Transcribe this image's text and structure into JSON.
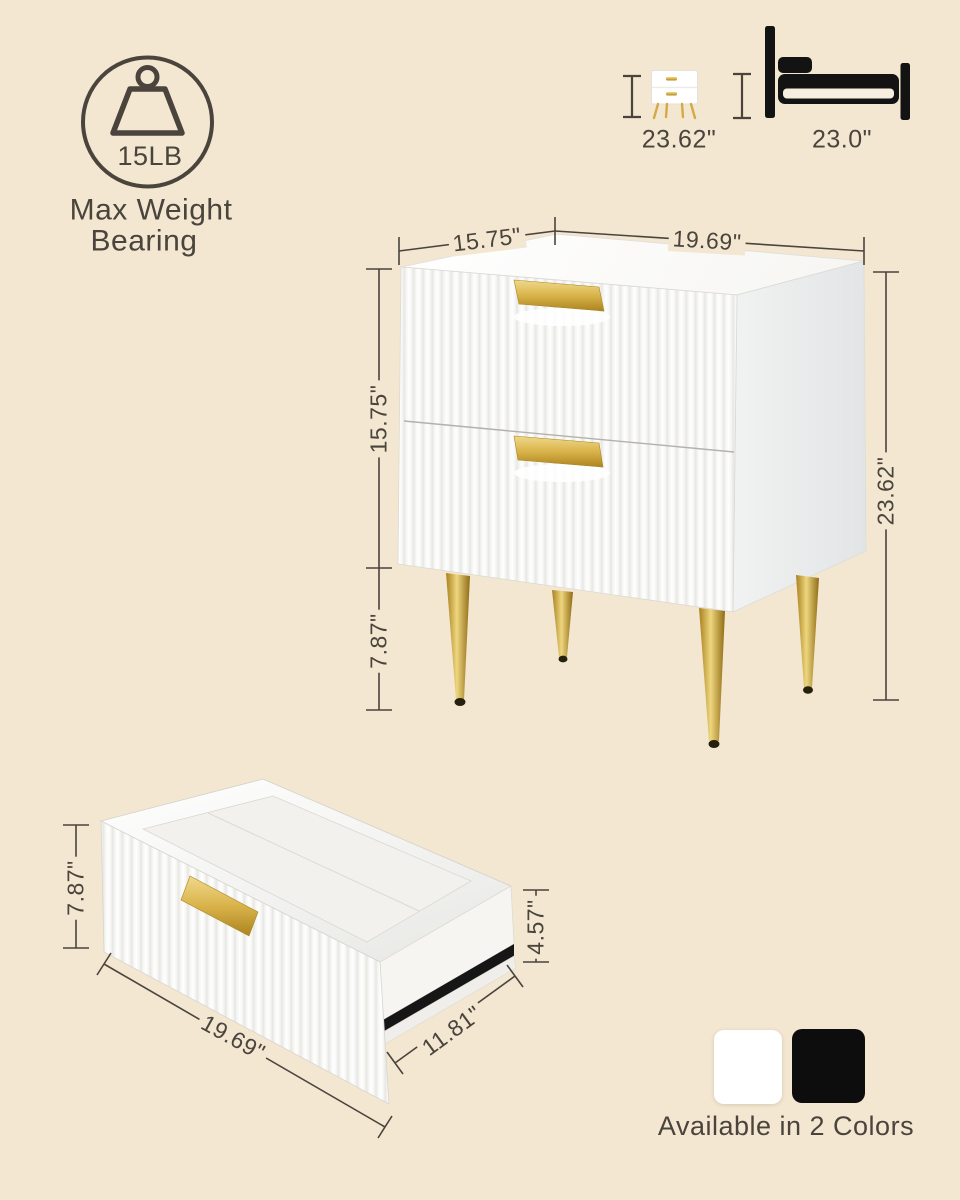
{
  "canvas": {
    "width": 960,
    "height": 1200,
    "background": "#f3e7d2",
    "ink": "#4a443c",
    "gold": "#d2ab45",
    "furniture_white": "#fdfdfc"
  },
  "weight_badge": {
    "icon": "weight-icon",
    "value": "15LB",
    "caption_line1": "Max Weight",
    "caption_line2": "Bearing"
  },
  "size_comparison": {
    "nightstand": {
      "icon": "nightstand-icon",
      "height_label": "23.62\""
    },
    "bed": {
      "icon": "bed-icon",
      "height_label": "23.0\""
    }
  },
  "main_diagram": {
    "labels": {
      "top_depth": "15.75\"",
      "top_width": "19.69\"",
      "cabinet_height": "15.75\"",
      "leg_height": "7.87\"",
      "overall_height": "23.62\""
    }
  },
  "drawer_diagram": {
    "labels": {
      "front_height": "7.87\"",
      "inner_depth": "4.57\"",
      "width": "19.69\"",
      "depth": "11.81\""
    }
  },
  "color_options": {
    "caption": "Available in 2 Colors",
    "swatches": [
      {
        "name": "white",
        "hex": "#ffffff"
      },
      {
        "name": "black",
        "hex": "#0d0d0d"
      }
    ]
  }
}
